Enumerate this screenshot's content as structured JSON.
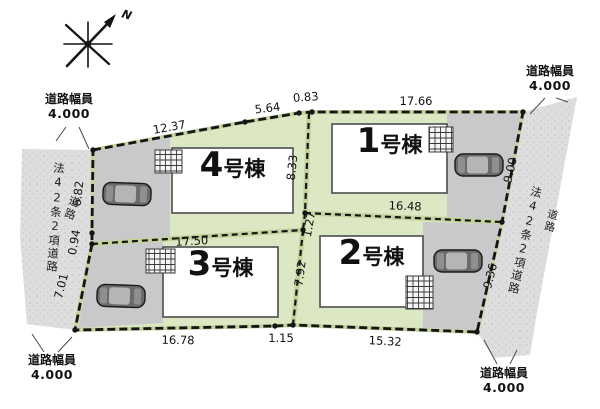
{
  "compass": {
    "label": "N"
  },
  "road_width_labels": {
    "top_left": {
      "name": "道路幅員",
      "value": "4.000"
    },
    "top_right": {
      "name": "道路幅員",
      "value": "4.000"
    },
    "bottom_left": {
      "name": "道路幅員",
      "value": "4.000"
    },
    "bottom_right": {
      "name": "道路幅員",
      "value": "4.000"
    }
  },
  "road_names": {
    "left_main": "法42条2項道路",
    "left_sub": "道路",
    "right_main": "法42条2項道路",
    "right_sub": "道路"
  },
  "lots": {
    "unit1": {
      "num": "1",
      "suffix": "号棟"
    },
    "unit2": {
      "num": "2",
      "suffix": "号棟"
    },
    "unit3": {
      "num": "3",
      "suffix": "号棟"
    },
    "unit4": {
      "num": "4",
      "suffix": "号棟"
    }
  },
  "dims": {
    "top_a": "12.37",
    "top_b": "5.64",
    "top_c": "0.83",
    "top_d": "17.66",
    "left_a": "6.82",
    "left_b": "0.94",
    "left_c": "7.01",
    "right_a": "9.00",
    "right_b": "9.36",
    "bottom_a": "16.78",
    "bottom_b": "1.15",
    "bottom_c": "15.32",
    "inner_a": "8.33",
    "inner_b": "16.48",
    "inner_c": "1.27",
    "inner_d": "17.50",
    "inner_e": "7.92"
  },
  "colors": {
    "lot_green": "#dce7c3",
    "lot_green_edge": "#c3d39e",
    "road_gray": "#dedede",
    "parking_gray": "#c9c9cb",
    "building_white": "#ffffff",
    "boundary_black": "#151515"
  }
}
